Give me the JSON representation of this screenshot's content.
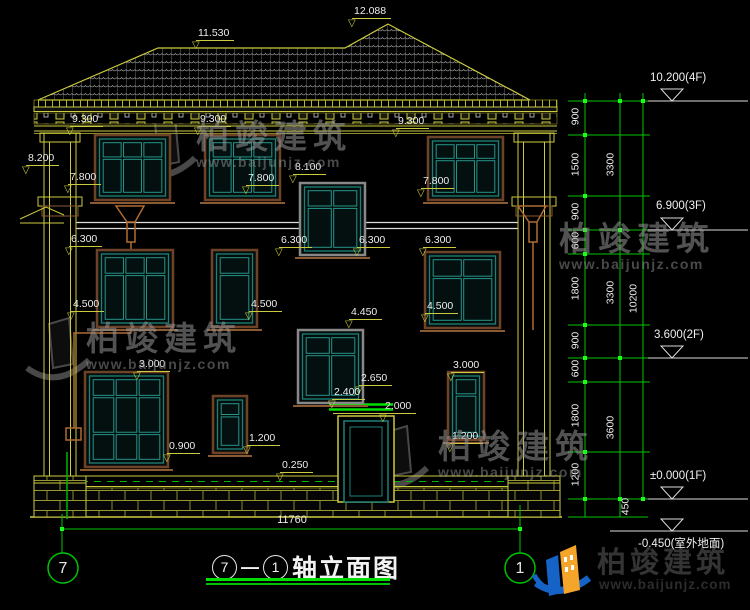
{
  "drawing": {
    "elevation_labels": [
      {
        "t": "12.088",
        "x": 352,
        "y": 6
      },
      {
        "t": "11.530",
        "x": 196,
        "y": 28
      },
      {
        "t": "9.300",
        "x": 70,
        "y": 114
      },
      {
        "t": "9.300",
        "x": 198,
        "y": 114
      },
      {
        "t": "9.300",
        "x": 396,
        "y": 116
      },
      {
        "t": "8.200",
        "x": 26,
        "y": 153
      },
      {
        "t": "7.800",
        "x": 68,
        "y": 172
      },
      {
        "t": "7.800",
        "x": 246,
        "y": 173
      },
      {
        "t": "8.100",
        "x": 293,
        "y": 162
      },
      {
        "t": "7.800",
        "x": 421,
        "y": 176
      },
      {
        "t": "6.300",
        "x": 69,
        "y": 234
      },
      {
        "t": "6.300",
        "x": 279,
        "y": 235
      },
      {
        "t": "6.300",
        "x": 357,
        "y": 235
      },
      {
        "t": "6.300",
        "x": 423,
        "y": 235
      },
      {
        "t": "4.500",
        "x": 71,
        "y": 299
      },
      {
        "t": "4.500",
        "x": 249,
        "y": 299
      },
      {
        "t": "4.450",
        "x": 349,
        "y": 307
      },
      {
        "t": "4.500",
        "x": 425,
        "y": 301
      },
      {
        "t": "3.000",
        "x": 137,
        "y": 359
      },
      {
        "t": "3.000",
        "x": 451,
        "y": 360
      },
      {
        "t": "2.650",
        "x": 359,
        "y": 373
      },
      {
        "t": "2.400",
        "x": 332,
        "y": 387
      },
      {
        "t": "2.000",
        "x": 383,
        "y": 401
      },
      {
        "t": "1.200",
        "x": 247,
        "y": 433
      },
      {
        "t": "1.200",
        "x": 450,
        "y": 431
      },
      {
        "t": "0.900",
        "x": 167,
        "y": 441
      },
      {
        "t": "0.250",
        "x": 280,
        "y": 460
      }
    ],
    "level_markers": [
      {
        "t": "10.200(4F)",
        "x": 650,
        "y": 72,
        "ly": 101,
        "lx": 648
      },
      {
        "t": "6.900(3F)",
        "x": 656,
        "y": 200,
        "ly": 230,
        "lx": 648
      },
      {
        "t": "3.600(2F)",
        "x": 654,
        "y": 329,
        "ly": 358,
        "lx": 648
      },
      {
        "t": "±0.000(1F)",
        "x": 650,
        "y": 470,
        "ly": 499,
        "lx": 648
      },
      {
        "t": "-0.450(室外地面)",
        "x": 638,
        "y": 535,
        "ly": 531,
        "lx": 610,
        "below": true
      }
    ],
    "dim_chains": [
      {
        "x": 585,
        "tx": 566,
        "segs": [
          [
            "900",
            101,
            135
          ],
          [
            "1500",
            135,
            196
          ],
          [
            "900",
            196,
            230
          ],
          [
            "600",
            230,
            254
          ],
          [
            "1800",
            254,
            325
          ],
          [
            "900",
            325,
            358
          ],
          [
            "600",
            358,
            382
          ],
          [
            "1800",
            382,
            452
          ],
          [
            "1200",
            452,
            499
          ]
        ]
      },
      {
        "x": 620,
        "tx": 601,
        "segs": [
          [
            "3300",
            101,
            230
          ],
          [
            "3300",
            230,
            358
          ],
          [
            "3600",
            358,
            499
          ]
        ]
      },
      {
        "x": 643,
        "tx": 624,
        "segs": [
          [
            "10200",
            101,
            499
          ]
        ]
      }
    ],
    "extra_dim": {
      "t": "450",
      "x": 602,
      "y": 501
    },
    "chain_levels": [
      101,
      135,
      196,
      230,
      254,
      325,
      358,
      382,
      452,
      499,
      517
    ],
    "bottom_dim": {
      "t": "11760"
    },
    "axis_bubbles": [
      {
        "t": "7",
        "cx": 63,
        "cy": 568
      },
      {
        "t": "1",
        "cx": 520,
        "cy": 568
      }
    ]
  },
  "title_block": {
    "axis_start": "7",
    "dash": "—",
    "axis_end": "1",
    "title": "轴立面图"
  },
  "watermarks": {
    "name": "柏竣建筑",
    "url": "www.baijunjz.com",
    "spots": [
      {
        "x": 196,
        "y": 120
      },
      {
        "x": 86,
        "y": 322
      },
      {
        "x": 438,
        "y": 430
      },
      {
        "x": 559,
        "y": 222
      }
    ]
  },
  "logo": {
    "name": "柏竣建筑",
    "url": "www.baijunjz.com"
  }
}
